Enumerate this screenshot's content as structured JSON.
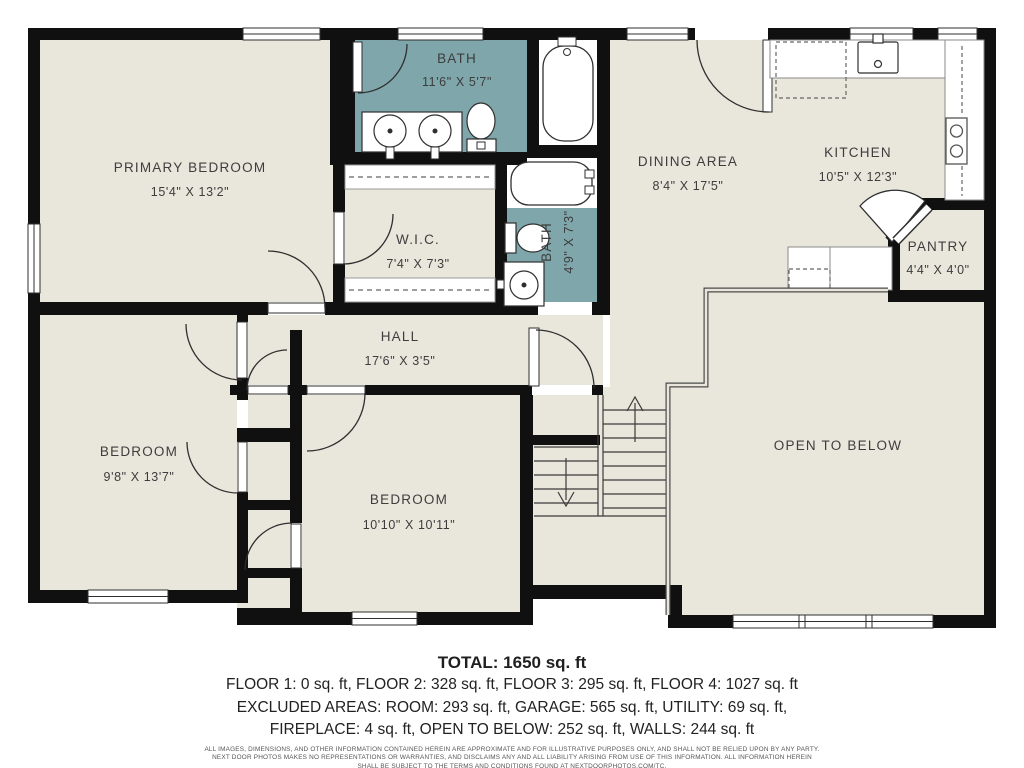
{
  "rooms": {
    "primary_bedroom": {
      "name": "PRIMARY BEDROOM",
      "dims": "15'4\" X 13'2\""
    },
    "bath_main": {
      "name": "BATH",
      "dims": "11'6\" X 5'7\""
    },
    "wic": {
      "name": "W.I.C.",
      "dims": "7'4\" X 7'3\""
    },
    "bath_hall": {
      "name": "BATH",
      "dims": "4'9\" X 7'3\""
    },
    "dining": {
      "name": "DINING AREA",
      "dims": "8'4\" X 17'5\""
    },
    "kitchen": {
      "name": "KITCHEN",
      "dims": "10'5\" X 12'3\""
    },
    "pantry": {
      "name": "PANTRY",
      "dims": "4'4\" X 4'0\""
    },
    "hall": {
      "name": "HALL",
      "dims": "17'6\" X 3'5\""
    },
    "bedroom_left": {
      "name": "BEDROOM",
      "dims": "9'8\" X 13'7\""
    },
    "bedroom_middle": {
      "name": "BEDROOM",
      "dims": "10'10\" X 10'11\""
    },
    "open_to_below": {
      "name": "OPEN TO BELOW"
    }
  },
  "summary": {
    "total": "TOTAL: 1650 sq. ft",
    "floors": "FLOOR 1: 0 sq. ft, FLOOR 2: 328 sq. ft, FLOOR 3: 295 sq. ft, FLOOR 4: 1027 sq. ft",
    "excluded1": "EXCLUDED AREAS: ROOM: 293 sq. ft, GARAGE: 565 sq. ft, UTILITY: 69 sq. ft,",
    "excluded2": "FIREPLACE: 4 sq. ft, OPEN TO BELOW: 252 sq. ft, WALLS: 244 sq. ft"
  },
  "disclaimer": {
    "line1": "ALL IMAGES, DIMENSIONS, AND OTHER INFORMATION CONTAINED HEREIN ARE APPROXIMATE AND FOR ILLUSTRATIVE PURPOSES ONLY, AND SHALL NOT BE RELIED UPON BY ANY PARTY.",
    "line2": "NEXT DOOR PHOTOS MAKES NO REPRESENTATIONS OR WARRANTIES, AND DISCLAIMS ANY AND ALL LIABILITY ARISING FROM USE OF THIS INFORMATION. ALL INFORMATION HEREIN",
    "line3": "SHALL BE SUBJECT TO THE TERMS AND CONDITIONS FOUND AT NEXTDOORPHOTOS.COM/TC."
  },
  "colors": {
    "floor": "#E9E7DC",
    "bath_floor": "#7FA6AA",
    "wall": "#101010",
    "background": "#FFFFFF",
    "label_text": "#3D3D3D"
  }
}
